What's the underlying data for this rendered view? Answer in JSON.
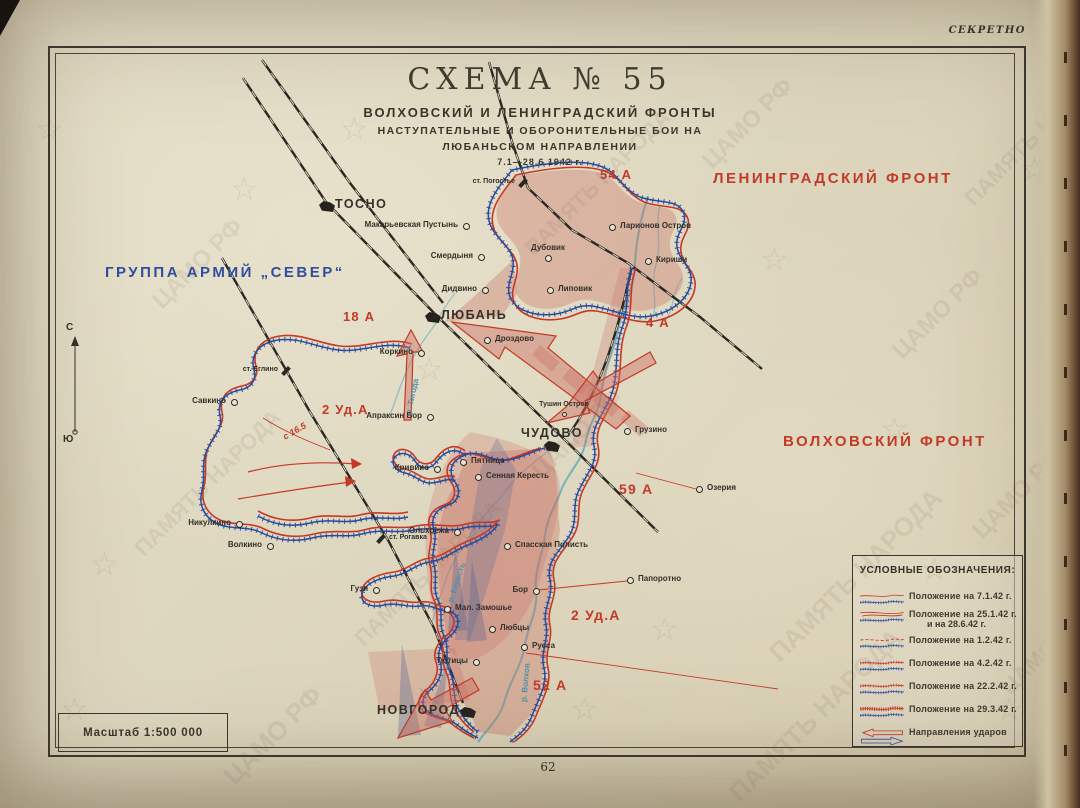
{
  "page": {
    "secret_label": "СЕКРЕТНО",
    "page_number": "62",
    "scale_label": "Масштаб 1:500 000"
  },
  "title": {
    "schema": "СХЕМА  № 55",
    "line1": "ВОЛХОВСКИЙ И ЛЕНИНГРАДСКИЙ ФРОНТЫ",
    "line2": "НАСТУПАТЕЛЬНЫЕ И ОБОРОНИТЕЛЬНЫЕ БОИ НА",
    "line3": "ЛЮБАНЬСКОМ НАПРАВЛЕНИИ",
    "line4": "7.1—28.6.1942 г."
  },
  "compass": {
    "north": "С",
    "south": "Ю"
  },
  "front_titles": [
    {
      "text": "ЛЕНИНГРАДСКИЙ ФРОНТ",
      "x": 713,
      "y": 170,
      "color": "#c23a28",
      "size": 15
    },
    {
      "text": "ВОЛХОВСКИЙ ФРОНТ",
      "x": 783,
      "y": 433,
      "color": "#c23a28",
      "size": 15
    },
    {
      "text": "ГРУППА АРМИЙ „СЕВЕР“",
      "x": 105,
      "y": 264,
      "color": "#2f4e9e",
      "size": 15
    }
  ],
  "armies": [
    {
      "name": "54 А",
      "x": 600,
      "y": 167,
      "size": 13
    },
    {
      "name": "18 А",
      "x": 343,
      "y": 309,
      "size": 13
    },
    {
      "name": "4 А",
      "x": 646,
      "y": 315,
      "size": 13
    },
    {
      "name": "2 Уд.А",
      "x": 322,
      "y": 402,
      "size": 13
    },
    {
      "name": "59 А",
      "x": 619,
      "y": 481,
      "size": 14
    },
    {
      "name": "2 Уд.А",
      "x": 571,
      "y": 607,
      "size": 14
    },
    {
      "name": "52 А",
      "x": 533,
      "y": 677,
      "size": 14
    }
  ],
  "towns": [
    {
      "name": "ТОСНО",
      "x": 327,
      "y": 206,
      "side": "r",
      "type": "city"
    },
    {
      "name": "ст. Погостье",
      "x": 523,
      "y": 183,
      "side": "l",
      "type": "station"
    },
    {
      "name": "Макарьевская Пустынь",
      "x": 466,
      "y": 226,
      "side": "l",
      "type": "town"
    },
    {
      "name": "Смердыня",
      "x": 481,
      "y": 257,
      "side": "l",
      "type": "town"
    },
    {
      "name": "Дубовик",
      "x": 548,
      "y": 258,
      "side": "a",
      "type": "town"
    },
    {
      "name": "Ларионов Остров",
      "x": 612,
      "y": 227,
      "side": "r",
      "type": "town"
    },
    {
      "name": "Кириши",
      "x": 648,
      "y": 261,
      "side": "r",
      "type": "town"
    },
    {
      "name": "Дидвино",
      "x": 485,
      "y": 290,
      "side": "l",
      "type": "town"
    },
    {
      "name": "Липовик",
      "x": 550,
      "y": 290,
      "side": "r",
      "type": "town"
    },
    {
      "name": "ЛЮБАНЬ",
      "x": 433,
      "y": 317,
      "side": "r",
      "type": "city"
    },
    {
      "name": "Дроздово",
      "x": 487,
      "y": 340,
      "side": "r",
      "type": "town"
    },
    {
      "name": "Коркино",
      "x": 421,
      "y": 353,
      "side": "l",
      "type": "town"
    },
    {
      "name": "ст. Еглино",
      "x": 286,
      "y": 371,
      "side": "l",
      "type": "station"
    },
    {
      "name": "Савкино",
      "x": 234,
      "y": 402,
      "side": "l",
      "type": "town"
    },
    {
      "name": "Апраксин Бор",
      "x": 430,
      "y": 417,
      "side": "l",
      "type": "town"
    },
    {
      "name": "Тушин Остров",
      "x": 564,
      "y": 414,
      "side": "a",
      "type": "small"
    },
    {
      "name": "ЧУДОВО",
      "x": 552,
      "y": 446,
      "side": "a",
      "type": "city"
    },
    {
      "name": "Грузино",
      "x": 627,
      "y": 431,
      "side": "r",
      "type": "town"
    },
    {
      "name": "Пятница",
      "x": 463,
      "y": 462,
      "side": "r",
      "type": "town"
    },
    {
      "name": "Сенная Кересть",
      "x": 478,
      "y": 477,
      "side": "r",
      "type": "town"
    },
    {
      "name": "Кривино",
      "x": 437,
      "y": 469,
      "side": "l",
      "type": "town"
    },
    {
      "name": "Озерия",
      "x": 699,
      "y": 489,
      "side": "r",
      "type": "town"
    },
    {
      "name": "Никулкино",
      "x": 239,
      "y": 524,
      "side": "l",
      "type": "town"
    },
    {
      "name": "Волкино",
      "x": 270,
      "y": 546,
      "side": "l",
      "type": "town"
    },
    {
      "name": "Ольхрежа",
      "x": 457,
      "y": 532,
      "side": "l",
      "type": "town"
    },
    {
      "name": "ст. Рогавка",
      "x": 381,
      "y": 539,
      "side": "r",
      "type": "station"
    },
    {
      "name": "Спасская Полисть",
      "x": 507,
      "y": 546,
      "side": "r",
      "type": "town"
    },
    {
      "name": "Папоротно",
      "x": 630,
      "y": 580,
      "side": "r",
      "type": "town"
    },
    {
      "name": "Гузи",
      "x": 376,
      "y": 590,
      "side": "l",
      "type": "town"
    },
    {
      "name": "Бор",
      "x": 536,
      "y": 591,
      "side": "l",
      "type": "town"
    },
    {
      "name": "Мал. Замошье",
      "x": 447,
      "y": 609,
      "side": "r",
      "type": "town"
    },
    {
      "name": "Любцы",
      "x": 492,
      "y": 629,
      "side": "r",
      "type": "town"
    },
    {
      "name": "Русса",
      "x": 524,
      "y": 647,
      "side": "r",
      "type": "town"
    },
    {
      "name": "Тютицы",
      "x": 476,
      "y": 662,
      "side": "l",
      "type": "town"
    },
    {
      "name": "НОВГОРОД",
      "x": 468,
      "y": 712,
      "side": "l",
      "type": "city"
    }
  ],
  "rivers": [
    {
      "name": "р. Тигода",
      "x": 394,
      "y": 392,
      "rot": -78
    },
    {
      "name": "р. Кересть",
      "x": 436,
      "y": 578,
      "rot": -72
    },
    {
      "name": "р. Волхов",
      "x": 506,
      "y": 678,
      "rot": -85
    }
  ],
  "annotations": [
    {
      "text": "с 16.5",
      "x": 282,
      "y": 426,
      "rot": -30
    }
  ],
  "legend": {
    "title": "УСЛОВНЫЕ ОБОЗНАЧЕНИЯ:",
    "items": [
      {
        "style": "s1",
        "label": "Положение на 7.1.42 г."
      },
      {
        "style": "s2",
        "label": "Положение на 25.1.42 г.",
        "label2": "и на 28.6.42 г."
      },
      {
        "style": "s3",
        "label": "Положение на 1.2.42 г."
      },
      {
        "style": "s4",
        "label": "Положение на 4.2.42 г."
      },
      {
        "style": "s5",
        "label": "Положение на 22.2.42 г."
      },
      {
        "style": "s6",
        "label": "Положение на 29.3.42 г."
      },
      {
        "style": "s7",
        "label": "Направления ударов"
      }
    ]
  },
  "watermark": {
    "texts": [
      "ЦАМО РФ",
      "ПАМЯТЬ НАРОДА"
    ]
  },
  "colors": {
    "front_red": "#c63826",
    "front_blue": "#2a4a9e",
    "pink_fill": "#e2a79b",
    "blue_fill": "#8794bc",
    "paper": "#ded7bf",
    "river": "#85bcc0",
    "label": "#33302a",
    "red_text": "#c23a28",
    "blue_text": "#2f4e9e"
  }
}
